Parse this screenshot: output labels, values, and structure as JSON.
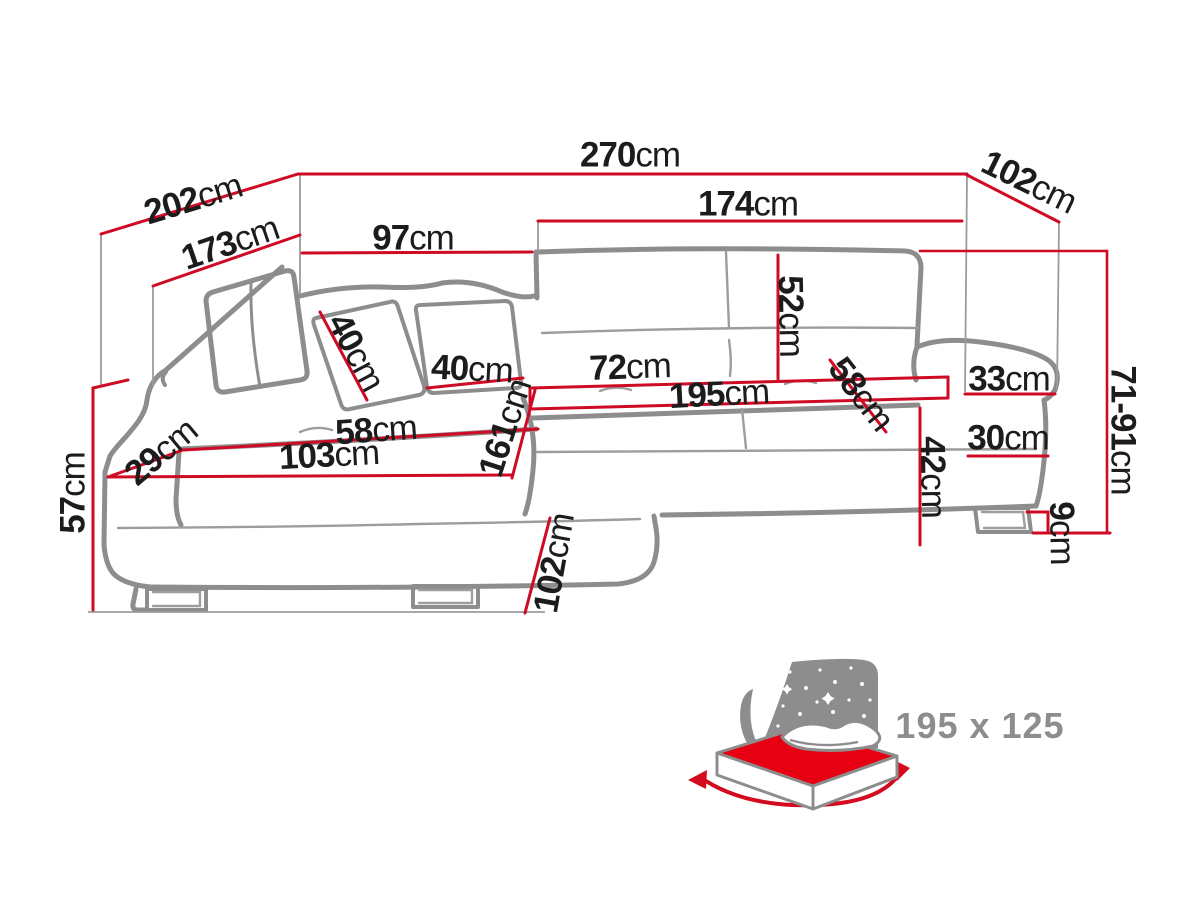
{
  "diagram": {
    "kind": "corner-sofa dimension drawing",
    "unit": "cm",
    "colors": {
      "dimension_red": "#cf0a24",
      "sofa_outline_gray": "#8d8d8d",
      "seam_gray": "#9d9d9d",
      "guide_gray": "#9b9b9b",
      "text_black": "#1c1c1c",
      "bed_icon_gray": "#8d8d8d",
      "bed_mattress_red": "#e60012",
      "label_gray": "#8d8d8d"
    },
    "dims": {
      "d270": {
        "value": "270",
        "unit": "cm"
      },
      "d202": {
        "value": "202",
        "unit": "cm"
      },
      "d173": {
        "value": "173",
        "unit": "cm"
      },
      "d97": {
        "value": "97",
        "unit": "cm"
      },
      "d174": {
        "value": "174",
        "unit": "cm"
      },
      "d102r": {
        "value": "102",
        "unit": "cm"
      },
      "d52": {
        "value": "52",
        "unit": "cm"
      },
      "d40a": {
        "value": "40",
        "unit": "cm"
      },
      "d40b": {
        "value": "40",
        "unit": "cm"
      },
      "d72": {
        "value": "72",
        "unit": "cm"
      },
      "d195": {
        "value": "195",
        "unit": "cm"
      },
      "d58r": {
        "value": "58",
        "unit": "cm"
      },
      "d33": {
        "value": "33",
        "unit": "cm"
      },
      "d7191": {
        "value": "71-91",
        "unit": "cm"
      },
      "d30": {
        "value": "30",
        "unit": "cm"
      },
      "d42": {
        "value": "42",
        "unit": "cm"
      },
      "d9": {
        "value": "9",
        "unit": "cm"
      },
      "d58l": {
        "value": "58",
        "unit": "cm"
      },
      "d103": {
        "value": "103",
        "unit": "cm"
      },
      "d161": {
        "value": "161",
        "unit": "cm"
      },
      "d29": {
        "value": "29",
        "unit": "cm"
      },
      "d57": {
        "value": "57",
        "unit": "cm"
      },
      "d102b": {
        "value": "102",
        "unit": "cm"
      }
    },
    "bed": {
      "sleeping_area_label": "195 x 125"
    }
  }
}
